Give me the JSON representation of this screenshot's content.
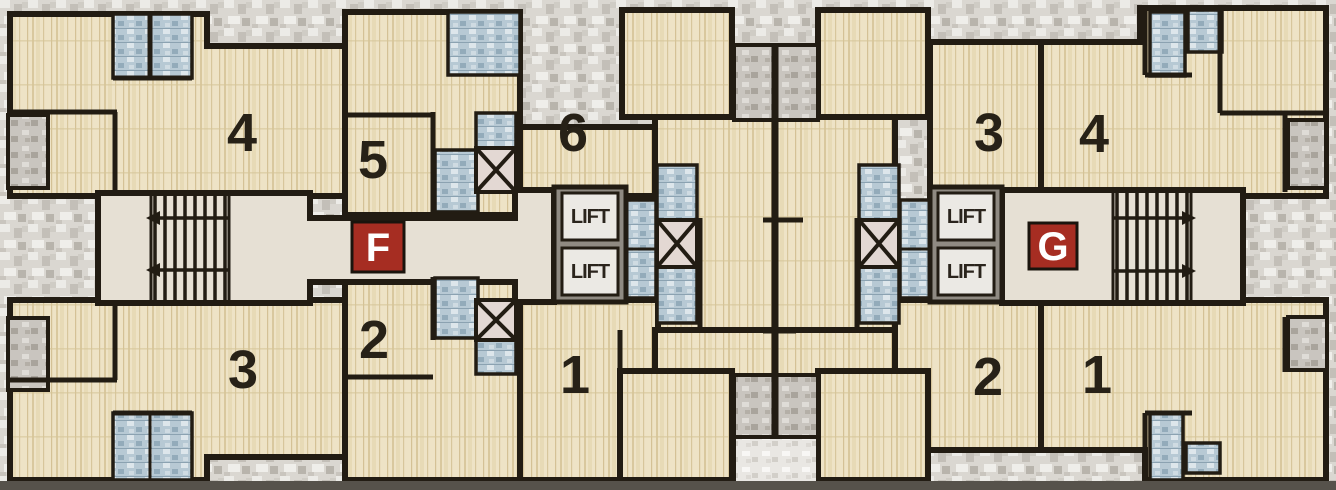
{
  "plan": {
    "wings": [
      {
        "badge": "F",
        "unit_labels_top": [
          "4",
          "5",
          "6"
        ],
        "unit_labels_bottom": [
          "3",
          "2",
          "1"
        ]
      },
      {
        "badge": "G",
        "unit_labels_top": [
          "3",
          "4"
        ],
        "unit_labels_bottom": [
          "2",
          "1"
        ]
      }
    ]
  },
  "labels": {
    "lift": "LIFT",
    "badge_f": "F",
    "badge_g": "G",
    "f_unit_top_left": "4",
    "f_unit_top_mid": "5",
    "f_unit_top_center": "6",
    "f_unit_bottom_left": "3",
    "f_unit_bottom_mid": "2",
    "f_unit_bottom_center": "1",
    "g_unit_top_left": "3",
    "g_unit_top_right": "4",
    "g_unit_bottom_left": "2",
    "g_unit_bottom_right": "1"
  },
  "colors": {
    "wall": "#221c13",
    "room_floor": "#eee3c6",
    "corridor_floor": "#e6e0d4",
    "window_glass": "#b7c9d4",
    "shaft_gray": "#c9c5bf",
    "badge_red": "#a62d22"
  }
}
